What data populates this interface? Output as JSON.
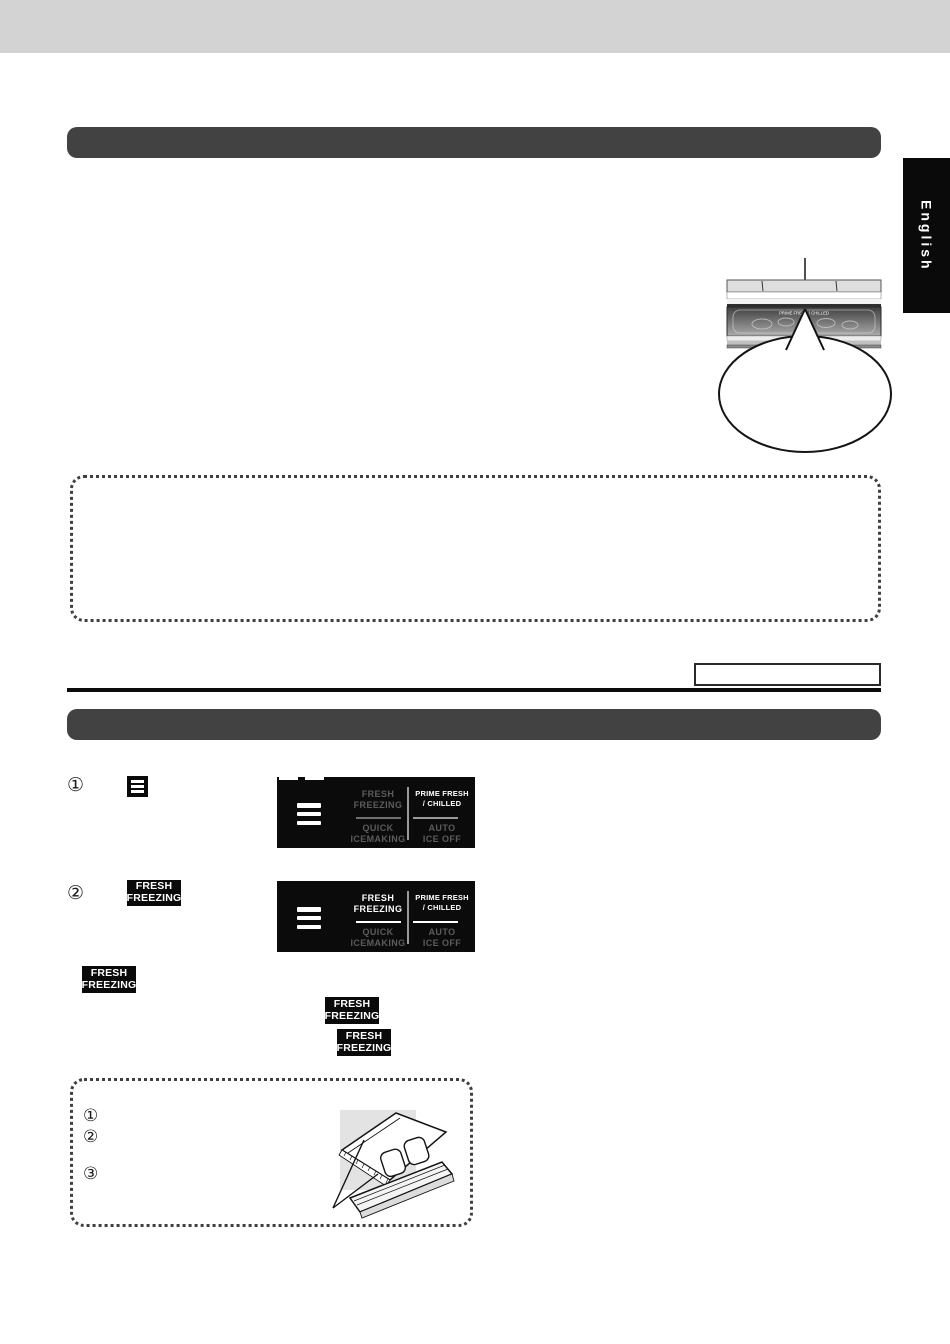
{
  "page": {
    "background": "#ffffff",
    "top_bar_color": "#d3d3d3",
    "section_bar_color": "#424242",
    "divider_color": "#0c0c0c"
  },
  "language_tab": {
    "label": "English"
  },
  "fridge_illustration": {
    "drawer_caption": "PRIME FRESH / CHILLED"
  },
  "steps": [
    {
      "number": "①"
    },
    {
      "number": "②"
    }
  ],
  "badge": {
    "line1": "FRESH",
    "line2": "FREEZING"
  },
  "panels": [
    {
      "cells": [
        {
          "line1": "FRESH",
          "line2": "FREEZING",
          "state": "dim"
        },
        {
          "line1": "PRIME FRESH",
          "line2": "/ CHILLED",
          "state": "on"
        },
        {
          "line1": "QUICK",
          "line2": "ICEMAKING",
          "state": "dim"
        },
        {
          "line1": "AUTO",
          "line2": "ICE OFF",
          "state": "dim"
        }
      ]
    },
    {
      "cells": [
        {
          "line1": "FRESH",
          "line2": "FREEZING",
          "state": "on"
        },
        {
          "line1": "PRIME FRESH",
          "line2": "/ CHILLED",
          "state": "on"
        },
        {
          "line1": "QUICK",
          "line2": "ICEMAKING",
          "state": "dim"
        },
        {
          "line1": "AUTO",
          "line2": "ICE OFF",
          "state": "dim"
        }
      ]
    }
  ],
  "note_box": {
    "items": [
      {
        "number": "①"
      },
      {
        "number": "②"
      },
      {
        "number": "③"
      }
    ]
  }
}
